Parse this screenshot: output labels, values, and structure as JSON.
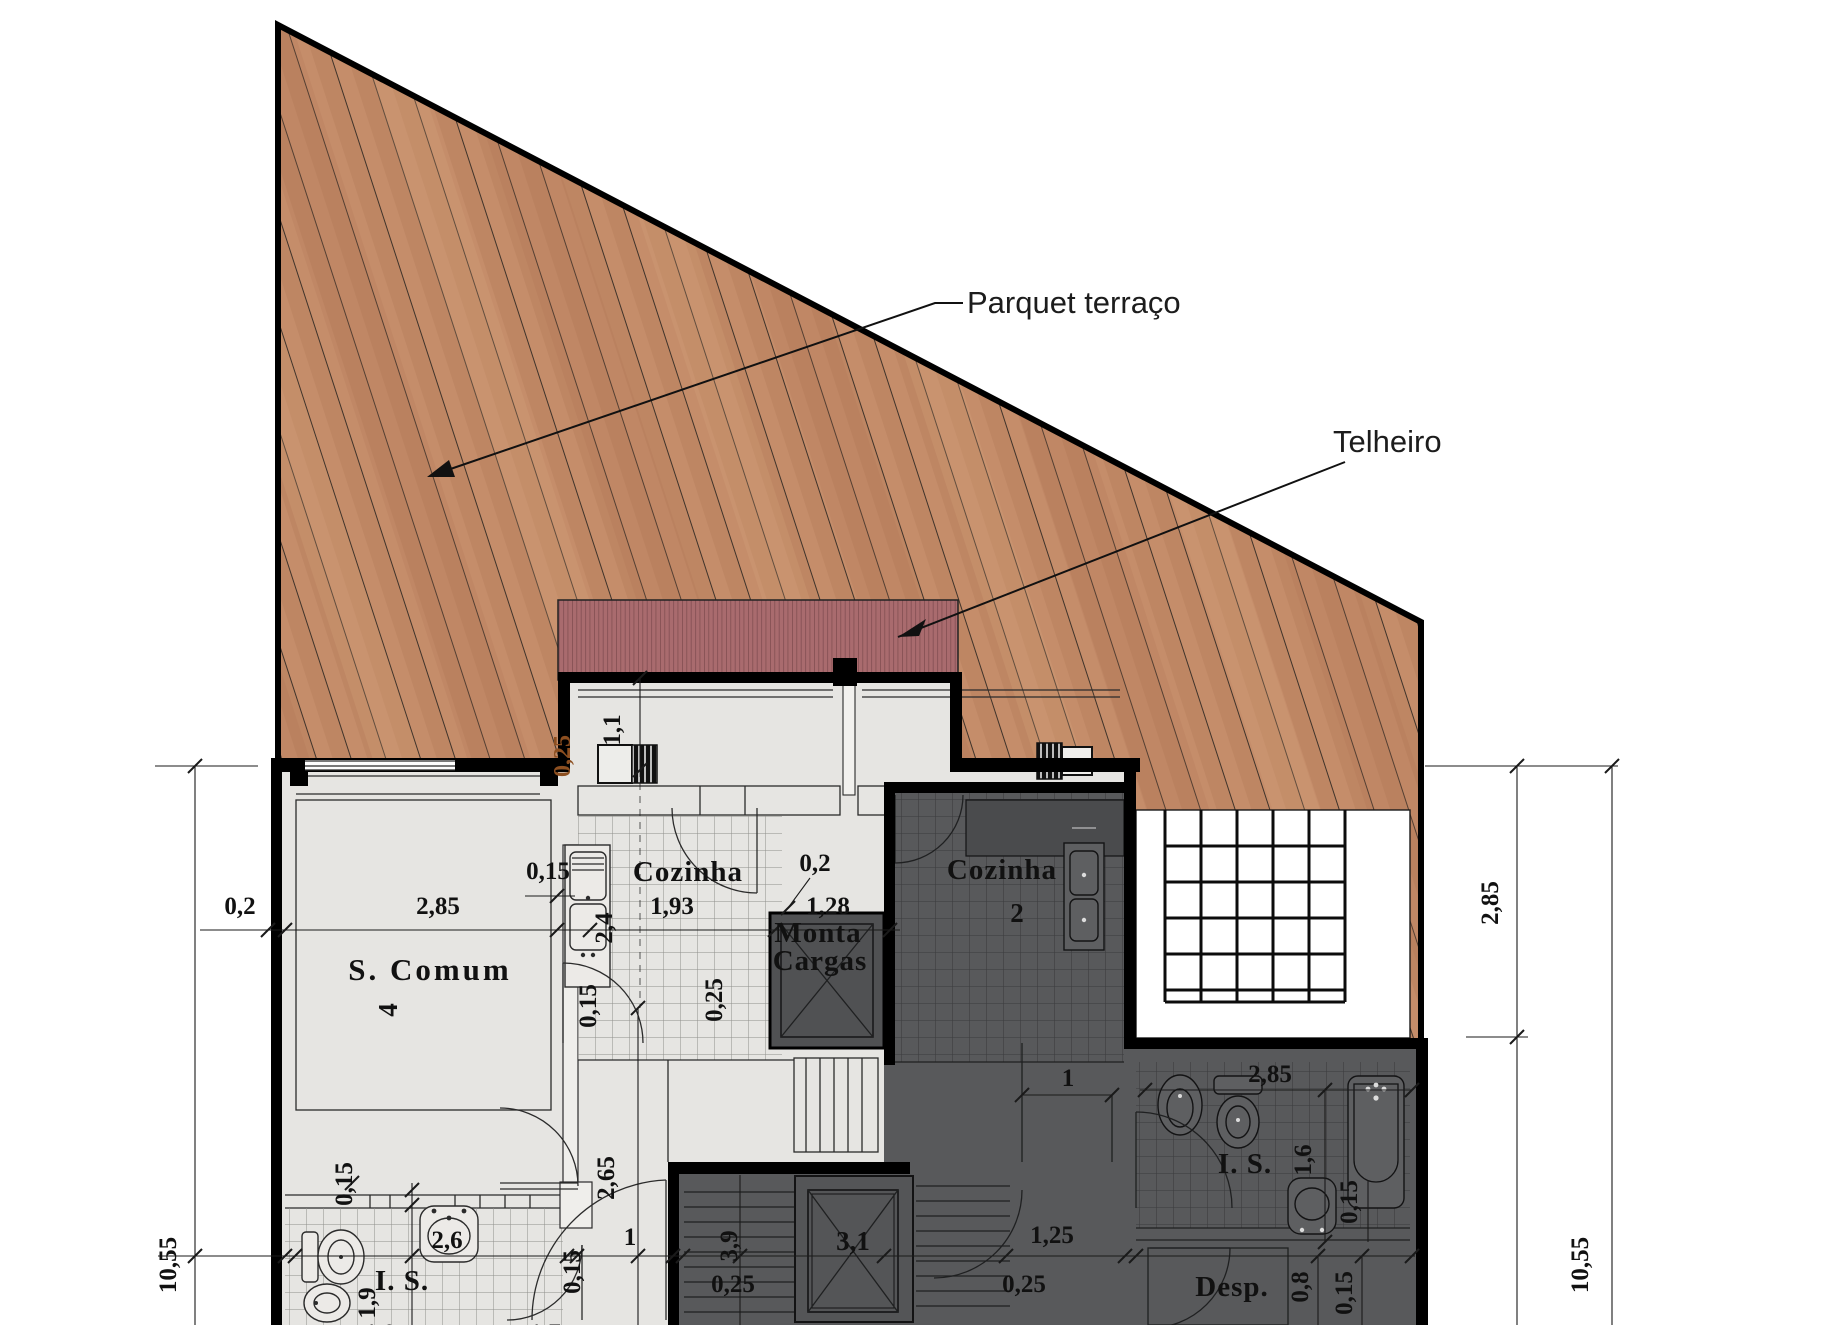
{
  "drawing": {
    "type": "architectural floor plan",
    "leaders": {
      "parquet": "Parquet terraço",
      "telheiro": "Telheiro"
    },
    "rooms": {
      "s_comum": "S. Comum",
      "s_comum_num": "4",
      "cozinha1": "Cozinha",
      "cozinha2": "Cozinha",
      "cozinha2_num": "2",
      "monta_line1": "Monta",
      "monta_line2": "Cargas",
      "is1": "I. S.",
      "is2": "I. S.",
      "desp": "Desp."
    },
    "dims": {
      "left_wall_02": "0,2",
      "scomum_w_285": "2,85",
      "wall_015": "0,15",
      "k_24": "2,4",
      "k_11": "1,1",
      "k_025_orange": "0,25",
      "k_193": "1,93",
      "k_02": "0,2",
      "monta_128": "1,28",
      "k_015": "0,15",
      "k_025": "0,25",
      "left_total_1055": "10,55",
      "c_265": "2,65",
      "c_door_1": "1",
      "c_39": "3,9",
      "c_025": "0,25",
      "lift_31": "3,1",
      "c_125": "1,25",
      "c_025b": "0,25",
      "b_26": "2,6",
      "b_19": "1,9",
      "b_015a": "0,15",
      "b_015b": "0,15",
      "b_cut_10": "1,0",
      "b_cut_17": "1,7",
      "d_door_1": "1",
      "d_285": "2,85",
      "d_16": "1,6",
      "d_015a": "0,15",
      "d_08": "0,8",
      "d_015b": "0,15",
      "r_285": "2,85",
      "r_total_1055": "10,55"
    },
    "colors": {
      "deck_base": "#c28a66",
      "deck_line": "#3f332a",
      "roof": "#a96b6e",
      "roof_stripe": "#7c4a4e",
      "unit_light": "#e6e5e2",
      "unit_dark": "#58595b",
      "wall": "#000000",
      "annotation_orange": "#8d4f20"
    }
  }
}
